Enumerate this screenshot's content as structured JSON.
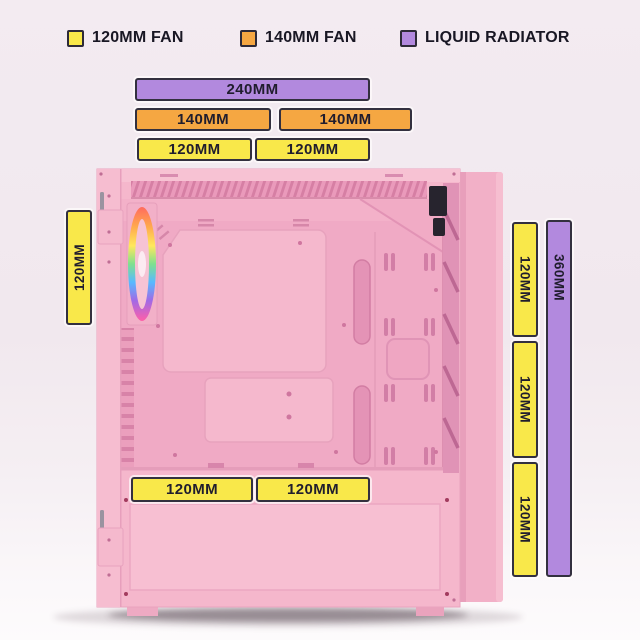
{
  "legend": {
    "items": [
      {
        "label": "120MM FAN",
        "color": "#F9E84A",
        "swatch": "yellow-square"
      },
      {
        "label": "140MM FAN",
        "color": "#F5A742",
        "swatch": "orange-square"
      },
      {
        "label": "LIQUID RADIATOR",
        "color": "#B289DE",
        "swatch": "purple-square"
      }
    ]
  },
  "bars": {
    "top": [
      {
        "label": "240MM",
        "type": "radiator"
      },
      {
        "label": "140MM",
        "type": "fan140"
      },
      {
        "label": "140MM",
        "type": "fan140"
      },
      {
        "label": "120MM",
        "type": "fan120"
      },
      {
        "label": "120MM",
        "type": "fan120"
      }
    ],
    "left": [
      {
        "label": "120MM",
        "type": "fan120"
      }
    ],
    "right": [
      {
        "label": "120MM",
        "type": "fan120"
      },
      {
        "label": "120MM",
        "type": "fan120"
      },
      {
        "label": "120MM",
        "type": "fan120"
      },
      {
        "label": "360MM",
        "type": "radiator"
      }
    ],
    "bottom": [
      {
        "label": "120MM",
        "type": "fan120"
      },
      {
        "label": "120MM",
        "type": "fan120"
      }
    ]
  },
  "colors": {
    "fan_120mm": "#F9E84A",
    "fan_140mm": "#F5A742",
    "liquid_radiator": "#B289DE",
    "bar_border": "#33303F",
    "text": "#191724",
    "case_pink": "#F5B7CC",
    "background_top": "#F3EBF1",
    "background_bottom": "#FDFBFC"
  },
  "illustration": {
    "subject": "pink mid-tower PC case, side view, RGB front fan"
  }
}
